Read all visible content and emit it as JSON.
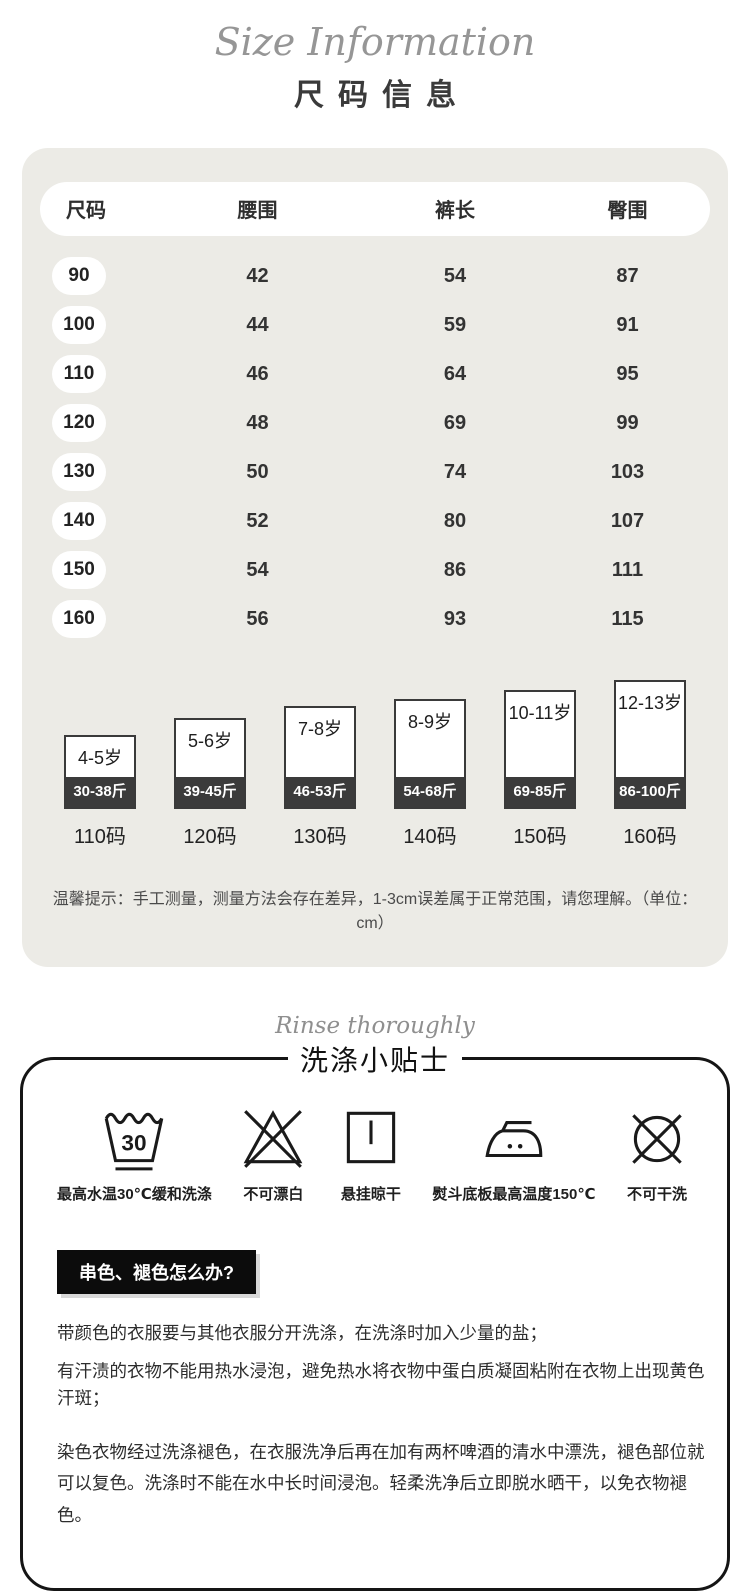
{
  "header": {
    "script_title": "Size Information",
    "title": "尺码信息"
  },
  "size_table": {
    "unit": "cm",
    "headers": [
      "尺码",
      "腰围",
      "裤长",
      "臀围"
    ],
    "rows": [
      {
        "size": "90",
        "waist": "42",
        "length": "54",
        "hip": "87"
      },
      {
        "size": "100",
        "waist": "44",
        "length": "59",
        "hip": "91"
      },
      {
        "size": "110",
        "waist": "46",
        "length": "64",
        "hip": "95"
      },
      {
        "size": "120",
        "waist": "48",
        "length": "69",
        "hip": "99"
      },
      {
        "size": "130",
        "waist": "50",
        "length": "74",
        "hip": "103"
      },
      {
        "size": "140",
        "waist": "52",
        "length": "80",
        "hip": "107"
      },
      {
        "size": "150",
        "waist": "54",
        "length": "86",
        "hip": "111"
      },
      {
        "size": "160",
        "waist": "56",
        "length": "93",
        "hip": "115"
      }
    ],
    "note": "温馨提示：手工测量，测量方法会存在差异，1-3cm误差属于正常范围，请您理解。（单位：cm）"
  },
  "age_boxes": [
    {
      "age": "4-5岁",
      "weight": "30-38斤",
      "size": "110码",
      "box_h": 74
    },
    {
      "age": "5-6岁",
      "weight": "39-45斤",
      "size": "120码",
      "box_h": 91
    },
    {
      "age": "7-8岁",
      "weight": "46-53斤",
      "size": "130码",
      "box_h": 103
    },
    {
      "age": "8-9岁",
      "weight": "54-68斤",
      "size": "140码",
      "box_h": 110
    },
    {
      "age": "10-11岁",
      "weight": "69-85斤",
      "size": "150码",
      "box_h": 119
    },
    {
      "age": "12-13岁",
      "weight": "86-100斤",
      "size": "160码",
      "box_h": 129
    }
  ],
  "wash_section": {
    "script_title": "Rinse thoroughly",
    "title": "洗涤小贴士",
    "icons": [
      {
        "name": "wash-30c-icon",
        "label": "最高水温30℃缓和洗涤"
      },
      {
        "name": "no-bleach-icon",
        "label": "不可漂白"
      },
      {
        "name": "hang-dry-icon",
        "label": "悬挂晾干"
      },
      {
        "name": "iron-150c-icon",
        "label": "熨斗底板最高温度150℃"
      },
      {
        "name": "no-dryclean-icon",
        "label": "不可干洗"
      }
    ],
    "question_label": "串色、褪色怎么办?",
    "paragraphs": [
      "带颜色的衣服要与其他衣服分开洗涤，在洗涤时加入少量的盐；",
      "有汗渍的衣物不能用热水浸泡，避免热水将衣物中蛋白质凝固粘附在衣物上出现黄色汗斑；",
      "染色衣物经过洗涤褪色，在衣服洗净后再在加有两杯啤酒的清水中漂洗，褪色部位就可以复色。洗涤时不能在水中长时间浸泡。轻柔洗净后立即脱水晒干，以免衣物褪色。"
    ]
  },
  "colors": {
    "panel_bg": "#ECEBE6",
    "dark_band": "#3B3B3B",
    "ink": "#2F2F2F",
    "label_bg": "#0C0C0C",
    "script_gray": "#969696"
  }
}
